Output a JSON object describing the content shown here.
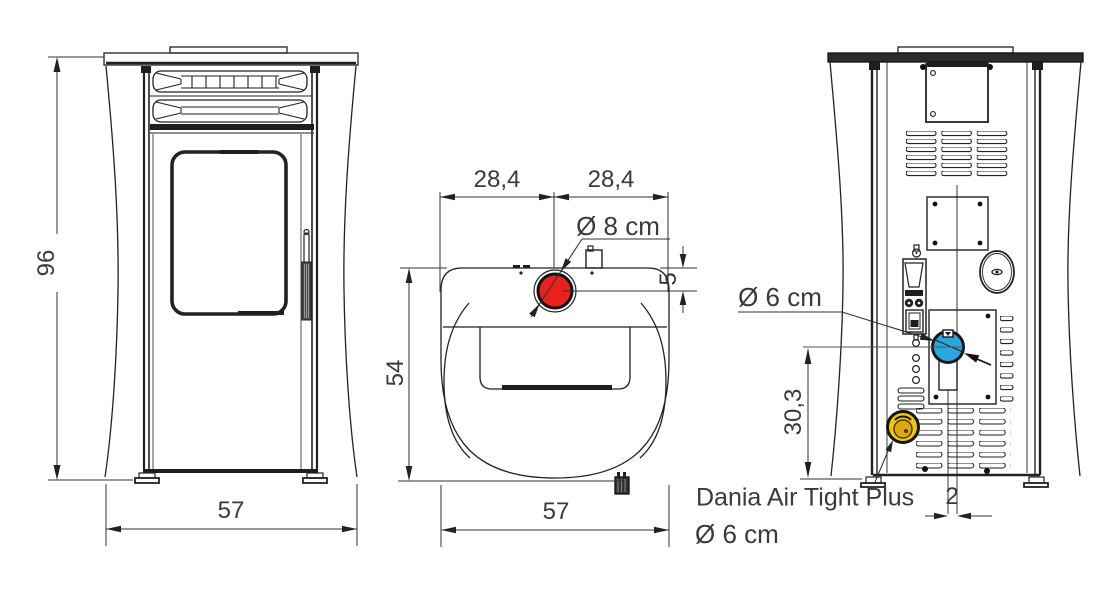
{
  "drawing": {
    "subject": "pellet stove dimension drawing",
    "views": [
      "front-view",
      "top-view",
      "rear-view"
    ]
  },
  "labels": {
    "front_height": "96",
    "front_width": "57",
    "top_half_left": "28,4",
    "top_half_right": "28,4",
    "top_flue_diameter": "Ø 8 cm",
    "top_flue_rear_offset": "5",
    "top_depth": "54",
    "top_width": "57",
    "rear_flue_diameter": "Ø 6 cm",
    "rear_flue_height": "30,3",
    "rear_flue_center_offset": "2",
    "air_intake_name": "Dania Air Tight Plus",
    "air_intake_diameter": "Ø 6 cm"
  },
  "colors": {
    "top_flue_outlet": "#e8211c",
    "rear_flue_outlet": "#29a7e0",
    "air_intake": "#f2c50d",
    "air_intake_inner": "#dfa90b",
    "line": "#222222",
    "text": "#3a3a3a"
  }
}
